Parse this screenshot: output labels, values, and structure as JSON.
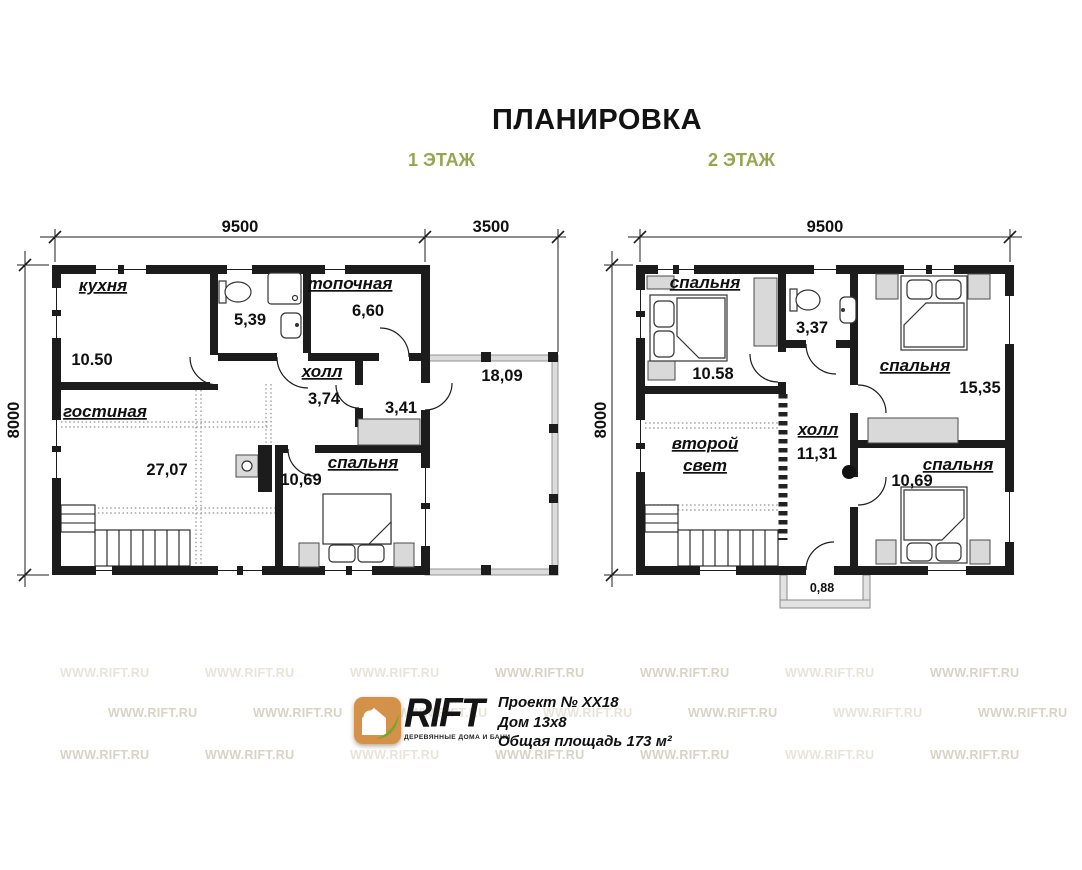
{
  "title": "ПЛАНИРОВКА",
  "floor1": {
    "label": "1 ЭТАЖ",
    "dim_top_main": "9500",
    "dim_top_terrace": "3500",
    "dim_left": "8000",
    "kitchen_name": "кухня",
    "kitchen_area": "10.50",
    "bath_area": "5,39",
    "boiler_name": "топочная",
    "boiler_area": "6,60",
    "hall_name": "холл",
    "hall_area": "3,74",
    "vestibule_area": "3,41",
    "living_name": "гостиная",
    "living_area": "27,07",
    "bedroom_name": "спальня",
    "bedroom_area": "10,69",
    "terrace_area": "18,09"
  },
  "floor2": {
    "label": "2 ЭТАЖ",
    "dim_top_main": "9500",
    "dim_left": "8000",
    "bedroom1_name": "спальня",
    "bedroom1_area": "10.58",
    "bath_area": "3,37",
    "bedroom2_name": "спальня",
    "bedroom2_area": "15,35",
    "void_name_1": "второй",
    "void_name_2": "свет",
    "hall_name": "холл",
    "hall_area": "11,31",
    "bedroom3_name": "спальня",
    "bedroom3_area": "10,69",
    "balcony_area": "0,88"
  },
  "branding": {
    "brand": "RIFT",
    "brand_sub": "ДЕРЕВЯННЫЕ ДОМА И БАНИ",
    "project": "Проект № ХХ18",
    "house": "Дом 13х8",
    "total_area": "Общая площадь 173 м²"
  },
  "watermark": "WWW.RIFT.RU",
  "colors": {
    "wall": "#1c1c1c",
    "floor_label_accent": "#95a651",
    "furniture_fill": "#d9d9d9",
    "watermark": "#d8d3c5",
    "logo_wood": "#d3914a",
    "logo_leaf": "#74a630"
  }
}
